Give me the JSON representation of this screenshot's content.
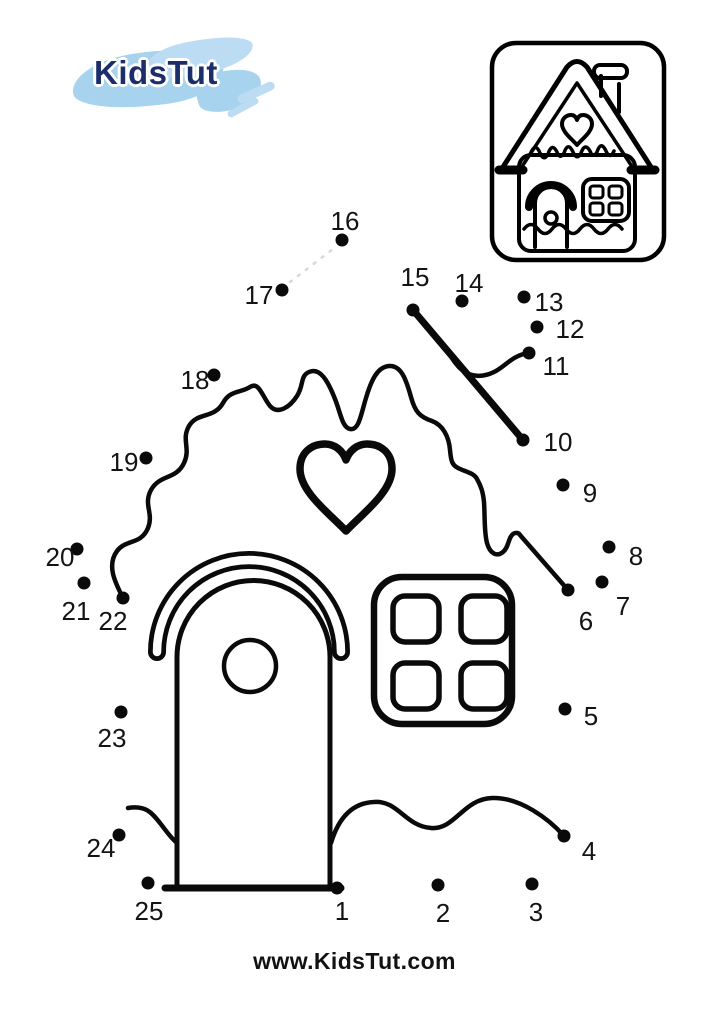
{
  "page": {
    "width": 709,
    "height": 1024,
    "background": "#ffffff"
  },
  "logo": {
    "text": "KidsTut",
    "text_color": "#1b2e6b",
    "brush_main": "#a7d3ee",
    "brush_light": "#bcdcf4"
  },
  "reference_preview": {
    "name": "finished-gingerbread-house-preview"
  },
  "puzzle": {
    "ink": "#0a0a0a",
    "guide_color": "#d8d8d8",
    "dot_radius": 6.5,
    "dots": [
      {
        "n": "1",
        "x": 337,
        "y": 888,
        "lx": 342,
        "ly": 920
      },
      {
        "n": "2",
        "x": 438,
        "y": 885,
        "lx": 443,
        "ly": 922
      },
      {
        "n": "3",
        "x": 532,
        "y": 884,
        "lx": 536,
        "ly": 921
      },
      {
        "n": "4",
        "x": 564,
        "y": 836,
        "lx": 589,
        "ly": 860
      },
      {
        "n": "5",
        "x": 565,
        "y": 709,
        "lx": 591,
        "ly": 725
      },
      {
        "n": "6",
        "x": 568,
        "y": 590,
        "lx": 586,
        "ly": 630
      },
      {
        "n": "7",
        "x": 602,
        "y": 582,
        "lx": 623,
        "ly": 615
      },
      {
        "n": "8",
        "x": 609,
        "y": 547,
        "lx": 636,
        "ly": 565
      },
      {
        "n": "9",
        "x": 563,
        "y": 485,
        "lx": 590,
        "ly": 502
      },
      {
        "n": "10",
        "x": 523,
        "y": 440,
        "lx": 558,
        "ly": 451
      },
      {
        "n": "11",
        "x": 529,
        "y": 353,
        "lx": 556,
        "ly": 375
      },
      {
        "n": "12",
        "x": 537,
        "y": 327,
        "lx": 570,
        "ly": 338
      },
      {
        "n": "13",
        "x": 524,
        "y": 297,
        "lx": 549,
        "ly": 311
      },
      {
        "n": "14",
        "x": 462,
        "y": 301,
        "lx": 469,
        "ly": 292
      },
      {
        "n": "15",
        "x": 413,
        "y": 310,
        "lx": 415,
        "ly": 286
      },
      {
        "n": "16",
        "x": 342,
        "y": 240,
        "lx": 345,
        "ly": 230
      },
      {
        "n": "17",
        "x": 282,
        "y": 290,
        "lx": 259,
        "ly": 304
      },
      {
        "n": "18",
        "x": 214,
        "y": 375,
        "lx": 195,
        "ly": 389
      },
      {
        "n": "19",
        "x": 146,
        "y": 458,
        "lx": 124,
        "ly": 471
      },
      {
        "n": "20",
        "x": 77,
        "y": 549,
        "lx": 60,
        "ly": 566
      },
      {
        "n": "21",
        "x": 84,
        "y": 583,
        "lx": 76,
        "ly": 620
      },
      {
        "n": "22",
        "x": 123,
        "y": 598,
        "lx": 113,
        "ly": 630
      },
      {
        "n": "23",
        "x": 121,
        "y": 712,
        "lx": 112,
        "ly": 747
      },
      {
        "n": "24",
        "x": 119,
        "y": 835,
        "lx": 101,
        "ly": 857
      },
      {
        "n": "25",
        "x": 148,
        "y": 883,
        "lx": 149,
        "ly": 920
      }
    ]
  },
  "footer": {
    "website": "www.KidsTut.com",
    "color": "#121212"
  }
}
